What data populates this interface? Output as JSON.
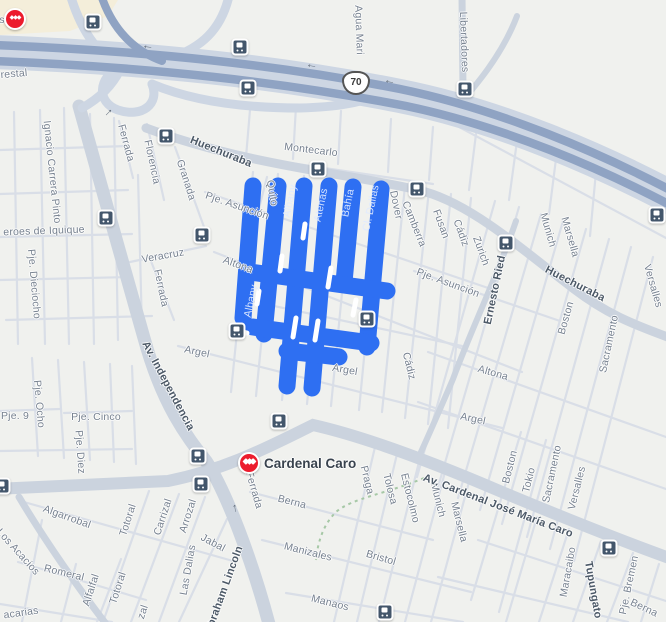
{
  "map": {
    "station": {
      "name": "Cardenal Caro"
    },
    "route_shield": "70",
    "colors": {
      "selection": "#2e6ff2",
      "highway": "#8fa3c3",
      "highway_bed": "#cdd6e3",
      "road": "#cbd3de",
      "minor_road": "#d9dee7",
      "background": "#f0f1ee",
      "label": "#76818f",
      "label_dark": "#4c5967",
      "metro_red": "#ec1c2d",
      "bus_navy": "#43566b"
    },
    "labels": [
      {
        "t": "s",
        "x": 2,
        "y": 20,
        "r": 0,
        "c": "d"
      },
      {
        "t": "restal",
        "x": 14,
        "y": 74,
        "r": -5,
        "c": "d"
      },
      {
        "t": "Agua Mari",
        "x": 359,
        "y": 30,
        "r": 88,
        "c": "d"
      },
      {
        "t": "Libertadores",
        "x": 464,
        "y": 42,
        "r": 88,
        "c": "d"
      },
      {
        "t": "Ignacio Carrera Pinto",
        "x": 52,
        "y": 172,
        "r": 84,
        "c": "d"
      },
      {
        "t": "Ferrada",
        "x": 126,
        "y": 143,
        "r": 75,
        "c": "d"
      },
      {
        "t": "Florencia",
        "x": 152,
        "y": 162,
        "r": 78,
        "c": "d"
      },
      {
        "t": "Granada",
        "x": 186,
        "y": 180,
        "r": 72,
        "c": "d"
      },
      {
        "t": "Huechuraba",
        "x": 221,
        "y": 152,
        "r": 22,
        "c": "b"
      },
      {
        "t": "Montecarlo",
        "x": 311,
        "y": 150,
        "r": 7,
        "c": "d"
      },
      {
        "t": "Pje. Asunción",
        "x": 237,
        "y": 206,
        "r": 19,
        "c": "d"
      },
      {
        "t": "Quito",
        "x": 272,
        "y": 193,
        "r": 80,
        "c": "d"
      },
      {
        "t": "Albany",
        "x": 290,
        "y": 201,
        "r": -78,
        "c": "w"
      },
      {
        "t": "Atenas",
        "x": 321,
        "y": 205,
        "r": -78,
        "c": "w"
      },
      {
        "t": "Bahía",
        "x": 348,
        "y": 203,
        "r": -78,
        "c": "w"
      },
      {
        "t": "Cl. Dallas",
        "x": 371,
        "y": 208,
        "r": -78,
        "c": "w"
      },
      {
        "t": "Dover",
        "x": 396,
        "y": 205,
        "r": 78,
        "c": "d"
      },
      {
        "t": "Camberra",
        "x": 414,
        "y": 224,
        "r": 68,
        "c": "d"
      },
      {
        "t": "Fusan",
        "x": 441,
        "y": 224,
        "r": 70,
        "c": "d"
      },
      {
        "t": "Cádiz",
        "x": 461,
        "y": 233,
        "r": 70,
        "c": "d"
      },
      {
        "t": "Zurich",
        "x": 481,
        "y": 251,
        "r": 70,
        "c": "d"
      },
      {
        "t": "Ernesto Ried",
        "x": 495,
        "y": 290,
        "r": -78,
        "c": "b"
      },
      {
        "t": "Munich",
        "x": 548,
        "y": 230,
        "r": 74,
        "c": "d"
      },
      {
        "t": "Marsella",
        "x": 570,
        "y": 237,
        "r": 74,
        "c": "d"
      },
      {
        "t": "Huechuraba",
        "x": 575,
        "y": 284,
        "r": 27,
        "c": "b"
      },
      {
        "t": "Versalles",
        "x": 653,
        "y": 286,
        "r": 74,
        "c": "d"
      },
      {
        "t": "Boston",
        "x": 566,
        "y": 318,
        "r": -74,
        "c": "d"
      },
      {
        "t": "Sacramento",
        "x": 609,
        "y": 344,
        "r": -78,
        "c": "d"
      },
      {
        "t": "eroes de Iquique",
        "x": 44,
        "y": 231,
        "r": -2,
        "c": "d"
      },
      {
        "t": "Pje. Dieciocho",
        "x": 34,
        "y": 284,
        "r": 85,
        "c": "d"
      },
      {
        "t": "Veracruz",
        "x": 163,
        "y": 256,
        "r": -10,
        "c": "d"
      },
      {
        "t": "Ferrada",
        "x": 161,
        "y": 288,
        "r": 78,
        "c": "d"
      },
      {
        "t": "Altona",
        "x": 238,
        "y": 265,
        "r": 20,
        "c": "d"
      },
      {
        "t": "Albany",
        "x": 251,
        "y": 301,
        "r": -78,
        "c": "w"
      },
      {
        "t": "Av. Independencia",
        "x": 168,
        "y": 386,
        "r": 62,
        "c": "b"
      },
      {
        "t": "Argel",
        "x": 197,
        "y": 352,
        "r": 12,
        "c": "d"
      },
      {
        "t": "Argel",
        "x": 345,
        "y": 370,
        "r": 10,
        "c": "d"
      },
      {
        "t": "Cádiz",
        "x": 409,
        "y": 366,
        "r": 76,
        "c": "d"
      },
      {
        "t": "Altona",
        "x": 493,
        "y": 373,
        "r": 16,
        "c": "d"
      },
      {
        "t": "Argel",
        "x": 473,
        "y": 419,
        "r": 12,
        "c": "d"
      },
      {
        "t": "Pje. Asunción",
        "x": 448,
        "y": 283,
        "r": 20,
        "c": "d"
      },
      {
        "t": "Pje. Ocho",
        "x": 39,
        "y": 404,
        "r": 85,
        "c": "d"
      },
      {
        "t": "Pje. 9",
        "x": 15,
        "y": 416,
        "r": 0,
        "c": "d"
      },
      {
        "t": "Pje. Cinco",
        "x": 96,
        "y": 417,
        "r": 0,
        "c": "d"
      },
      {
        "t": "Pje. Diez",
        "x": 80,
        "y": 452,
        "r": 86,
        "c": "d"
      },
      {
        "t": "Ferrada",
        "x": 254,
        "y": 490,
        "r": 74,
        "c": "d"
      },
      {
        "t": "Berna",
        "x": 292,
        "y": 502,
        "r": 14,
        "c": "d"
      },
      {
        "t": "Praga",
        "x": 367,
        "y": 480,
        "r": 76,
        "c": "d"
      },
      {
        "t": "Tolosa",
        "x": 390,
        "y": 489,
        "r": 76,
        "c": "d"
      },
      {
        "t": "Estocolmo",
        "x": 410,
        "y": 498,
        "r": 76,
        "c": "d"
      },
      {
        "t": "Munich",
        "x": 438,
        "y": 500,
        "r": 76,
        "c": "d"
      },
      {
        "t": "Marsella",
        "x": 459,
        "y": 522,
        "r": 76,
        "c": "d"
      },
      {
        "t": "Av. Cardenal José María Caro",
        "x": 498,
        "y": 506,
        "r": 21,
        "c": "b"
      },
      {
        "t": "Boston",
        "x": 510,
        "y": 467,
        "r": -76,
        "c": "d"
      },
      {
        "t": "Tokio",
        "x": 529,
        "y": 480,
        "r": -76,
        "c": "d"
      },
      {
        "t": "Sacramento",
        "x": 552,
        "y": 474,
        "r": -78,
        "c": "d"
      },
      {
        "t": "Versalles",
        "x": 577,
        "y": 488,
        "r": -76,
        "c": "d"
      },
      {
        "t": "Algarrobal",
        "x": 67,
        "y": 517,
        "r": 20,
        "c": "d"
      },
      {
        "t": "Totoral",
        "x": 128,
        "y": 520,
        "r": -72,
        "c": "d"
      },
      {
        "t": "Carrizal",
        "x": 163,
        "y": 517,
        "r": -72,
        "c": "d"
      },
      {
        "t": "Arrozal",
        "x": 188,
        "y": 516,
        "r": -72,
        "c": "d"
      },
      {
        "t": "Jabal",
        "x": 213,
        "y": 543,
        "r": 28,
        "c": "d"
      },
      {
        "t": "Las Dalias",
        "x": 188,
        "y": 570,
        "r": -80,
        "c": "d"
      },
      {
        "t": "Los Acacios",
        "x": 18,
        "y": 552,
        "r": 48,
        "c": "d"
      },
      {
        "t": "Romeral",
        "x": 64,
        "y": 573,
        "r": 14,
        "c": "d"
      },
      {
        "t": "Alfalfal",
        "x": 91,
        "y": 590,
        "r": -72,
        "c": "d"
      },
      {
        "t": "Totoral",
        "x": 118,
        "y": 588,
        "r": -72,
        "c": "d"
      },
      {
        "t": "zal",
        "x": 143,
        "y": 612,
        "r": -72,
        "c": "d"
      },
      {
        "t": "acarias",
        "x": 21,
        "y": 613,
        "r": -8,
        "c": "d"
      },
      {
        "t": "Abraham Lincoln",
        "x": 224,
        "y": 590,
        "r": -70,
        "c": "b"
      },
      {
        "t": "Manizales",
        "x": 308,
        "y": 552,
        "r": 14,
        "c": "d"
      },
      {
        "t": "Bristol",
        "x": 381,
        "y": 558,
        "r": 16,
        "c": "d"
      },
      {
        "t": "Manaos",
        "x": 330,
        "y": 603,
        "r": 14,
        "c": "d"
      },
      {
        "t": "Maracaibo",
        "x": 568,
        "y": 572,
        "r": -80,
        "c": "d"
      },
      {
        "t": "Tupungato",
        "x": 593,
        "y": 590,
        "r": 80,
        "c": "b"
      },
      {
        "t": "Pje. Bremen",
        "x": 629,
        "y": 585,
        "r": -78,
        "c": "d"
      },
      {
        "t": "Berna",
        "x": 644,
        "y": 608,
        "r": 25,
        "c": "d"
      }
    ],
    "bus_stops": [
      [
        93,
        22
      ],
      [
        240,
        47
      ],
      [
        248,
        88
      ],
      [
        465,
        89
      ],
      [
        166,
        136
      ],
      [
        318,
        169
      ],
      [
        417,
        189
      ],
      [
        106,
        218
      ],
      [
        202,
        235
      ],
      [
        506,
        243
      ],
      [
        657,
        215
      ],
      [
        367,
        319
      ],
      [
        237,
        331
      ],
      [
        279,
        421
      ],
      [
        198,
        456
      ],
      [
        201,
        484
      ],
      [
        2,
        486
      ],
      [
        609,
        548
      ],
      [
        385,
        612
      ]
    ],
    "metro_icons": [
      [
        15,
        19
      ]
    ],
    "arrows": [
      {
        "g": "←",
        "x": 148,
        "y": 45,
        "r": 8
      },
      {
        "g": "←",
        "x": 312,
        "y": 64,
        "r": 10
      },
      {
        "g": "←",
        "x": 390,
        "y": 80,
        "r": 12
      },
      {
        "g": "←",
        "x": 237,
        "y": 508,
        "r": 80
      },
      {
        "g": "←",
        "x": 110,
        "y": 114,
        "r": 135
      }
    ]
  }
}
